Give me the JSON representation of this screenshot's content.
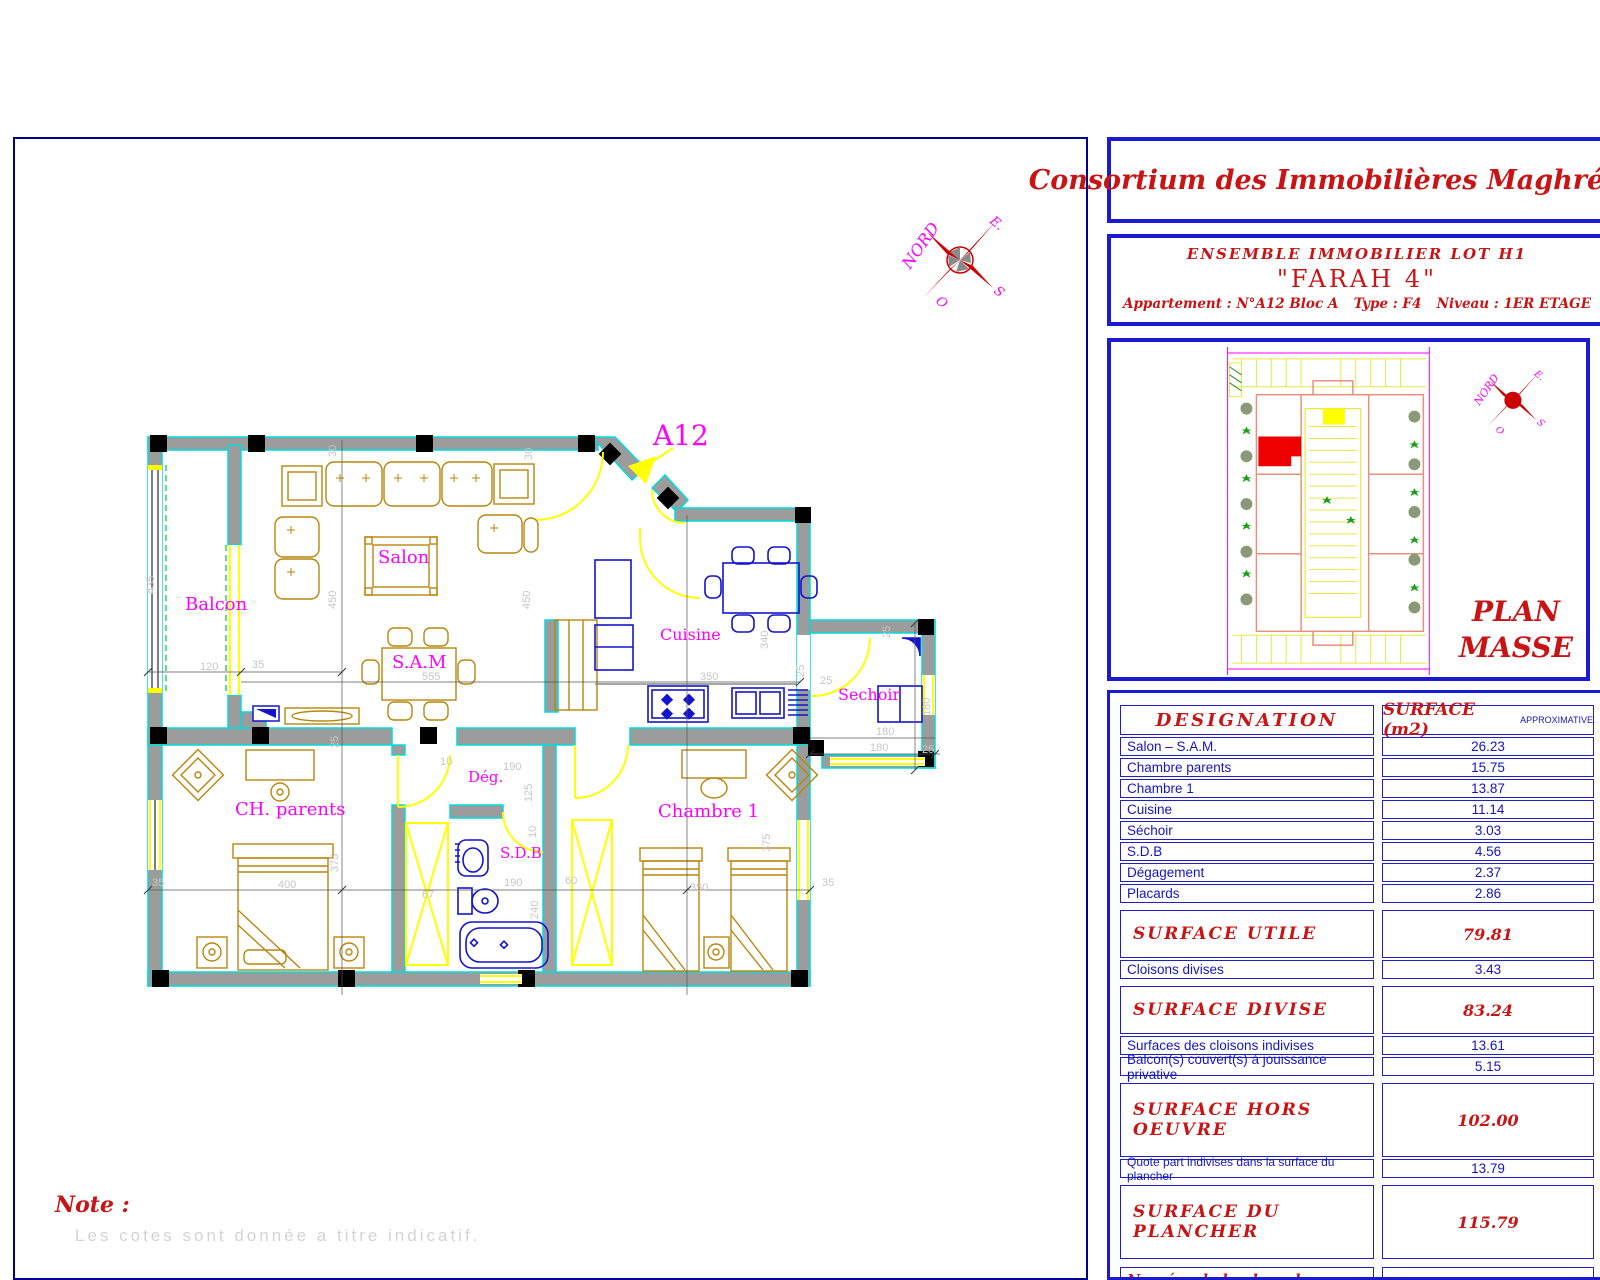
{
  "titleblock": {
    "company": "Consortium des Immobilières Maghrébines",
    "project_line": "ENSEMBLE   IMMOBILIER  LOT  H1",
    "project_name": "\"FARAH 4\"",
    "apartment": "Appartement :  N°A12  Bloc A",
    "type": "Type :  F4",
    "level": "Niveau :  1ER ETAGE"
  },
  "plan_masse": {
    "title_line1": "PLAN",
    "title_line2": "MASSE"
  },
  "compass": {
    "north": "NORD",
    "east": "E.",
    "west": "O",
    "south": "S"
  },
  "plan": {
    "unit_label": "A12",
    "rooms": {
      "balcon": "Balcon",
      "salon": "Salon",
      "sam": "S.A.M",
      "cuisine": "Cuisine",
      "sechoir": "Sechoir",
      "ch_parents": "CH. parents",
      "degagement": "Dég.",
      "sdb": "S.D.B",
      "chambre1": "Chambre 1"
    },
    "dims": [
      "30",
      "30",
      "435",
      "450",
      "450",
      "555",
      "120",
      "35",
      "340",
      "350",
      "25",
      "25",
      "180",
      "180",
      "25",
      "25",
      "10",
      "190",
      "125",
      "10",
      "375",
      "400",
      "35",
      "67",
      "190",
      "240",
      "350",
      "375",
      "60",
      "35",
      "180",
      "25"
    ]
  },
  "table": {
    "header": {
      "designation": "DESIGNATION",
      "surface": "SURFACE  (m2)",
      "approx": "APPROXIMATIVE"
    },
    "rows": [
      {
        "label": "Salon – S.A.M.",
        "value": "26.23"
      },
      {
        "label": "Chambre parents",
        "value": "15.75"
      },
      {
        "label": "Chambre 1",
        "value": "13.87"
      },
      {
        "label": "Cuisine",
        "value": "11.14"
      },
      {
        "label": "Séchoir",
        "value": "3.03"
      },
      {
        "label": "S.D.B",
        "value": "4.56"
      },
      {
        "label": "Dégagement",
        "value": "2.37"
      },
      {
        "label": "Placards",
        "value": "2.86"
      },
      {
        "label": "SURFACE  UTILE",
        "value": "79.81"
      },
      {
        "label": "Cloisons divises",
        "value": "3.43"
      },
      {
        "label": "SURFACE  DIVISE",
        "value": "83.24"
      },
      {
        "label": "Surfaces des cloisons indivises",
        "value": "13.61"
      },
      {
        "label": "Balcon(s) couvert(s) à jouissance privative",
        "value": "5.15"
      },
      {
        "label": "SURFACE  HORS  OEUVRE",
        "value": "102.00"
      },
      {
        "label": "Quote part indivises dans la surface du plancher",
        "value": "13.79"
      },
      {
        "label": "SURFACE  DU  PLANCHER",
        "value": "115.79"
      },
      {
        "label": "Numéro de la place de parking",
        "value": "--"
      }
    ]
  },
  "note": {
    "title": "Note :",
    "text": "Les cotes sont donnée a titre indicatif."
  }
}
